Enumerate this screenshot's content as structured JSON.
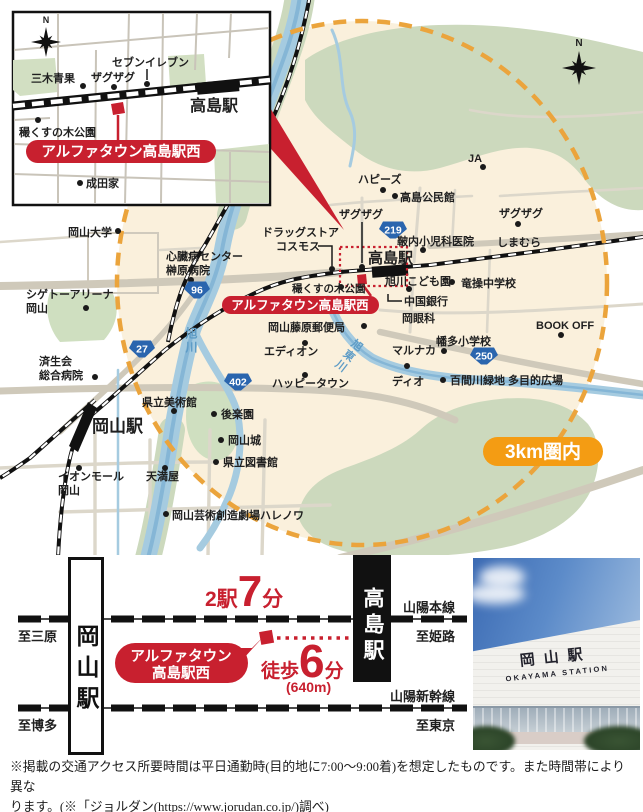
{
  "inset": {
    "north": "N",
    "station_label": "高島駅",
    "site_badge": "アルファタウン高島駅西",
    "labels": {
      "seven_eleven": "セブンイレブン",
      "miki_seika": "三木青果",
      "zagzag": "ザグザグ",
      "kunugi_park": "穝くすの木公園",
      "naritaya": "成田家"
    }
  },
  "map": {
    "north": "N",
    "badge_3km": "3km圏内",
    "site_badge": "アルファタウン高島駅西",
    "station_takashima": "高島駅",
    "station_okayama": "岡山駅",
    "routes": {
      "r96": "96",
      "r27": "27",
      "r402": "402",
      "r219": "219",
      "r250": "250"
    },
    "rivers": {
      "asahi": "旭川",
      "asahi_higashi": "旭東川"
    },
    "labels": {
      "okayama_univ": "岡山大学",
      "drugstore_1": "ドラッグストア",
      "drugstore_2": "コスモス",
      "heart_center_1": "心臓病センター",
      "heart_center_2": "榊原病院",
      "shigeto_1": "シゲトーアリーナ",
      "shigeto_2": "岡山",
      "saiseikai_1": "済生会",
      "saiseikai_2": "総合病院",
      "kunugi_park": "穝くすの木公園",
      "fujiwara_post": "岡山藤原郵便局",
      "edion": "エディオン",
      "happy_town": "ハッピータウン",
      "art_museum": "県立美術館",
      "korakuen": "後楽園",
      "okayama_castle": "岡山城",
      "pref_library": "県立図書館",
      "tenmaya": "天満屋",
      "aeon_1": "イオンモール",
      "aeon_2": "岡山",
      "halenowa": "岡山芸術創造劇場ハレノワ",
      "marunaka": "マルナカ",
      "dio": "ディオ",
      "hyakken": "百間川緑地 多目的広場",
      "hata_elem": "幡多小学校",
      "ryuso_jhs": "竜操中学校",
      "chugoku_bank": "中国銀行",
      "oka_ganka": "岡眼科",
      "kodomoen": "旭川こども園",
      "pediatric_clinic": "鞁内小児科医院",
      "zagzag_w": "ザグザグ",
      "zagzag_e": "ザグザグ",
      "shimamura": "しまむら",
      "kominkan": "高島公民館",
      "happys": "ハピーズ",
      "ja": "JA",
      "bookoff": "BOOK OFF"
    }
  },
  "access": {
    "stations": {
      "okayama": "岡山駅",
      "takashima": "高島駅"
    },
    "ride": {
      "prefix": "2駅",
      "num": "7",
      "suffix": "分"
    },
    "walk": {
      "prefix": "徒歩",
      "num": "6",
      "suffix": "分",
      "distance": "(640m)"
    },
    "site_badge_1": "アルファタウン",
    "site_badge_2": "高島駅西",
    "lines": {
      "sanyo_main": "山陽本線",
      "sanyo_shinkansen": "山陽新幹線"
    },
    "directions": {
      "mihara": "至三原",
      "himeji": "至姫路",
      "hakata": "至博多",
      "tokyo": "至東京"
    }
  },
  "photo": {
    "sign_jp": "岡山駅",
    "sign_en": "OKAYAMA STATION"
  },
  "footnote": {
    "line1": "※掲載の交通アクセス所要時間は平日通勤時(目的地に7:00〜9:00着)を想定したものです。また時間帯により異な",
    "line2": "ります。(※「ジョルダン(https://www.jorudan.co.jp/)調べ)"
  },
  "colors": {
    "red": "#c8202f",
    "orange": "#f49c13",
    "circle_dash": "#eba43c",
    "route_blue": "#2a65ae",
    "beige": "#faf0dc",
    "green": "#ccd9bd",
    "water": "#a5cbe0",
    "road": "#cfc9ba"
  }
}
